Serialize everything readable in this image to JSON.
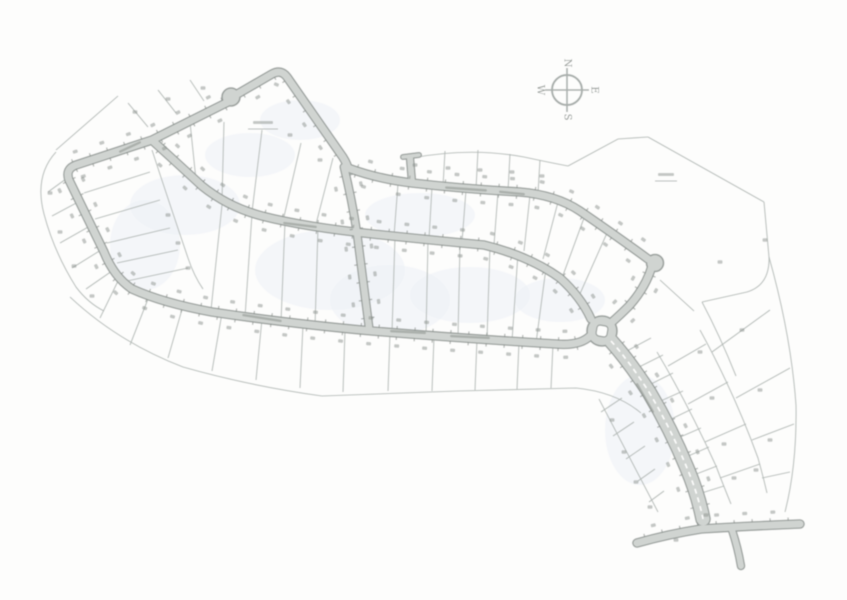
{
  "map": {
    "width": 847,
    "height": 600,
    "colors": {
      "bg": "#fdfdfc",
      "road_fill": "#d0d4d1",
      "road_casing": "#9ba19e",
      "parcel": "#b4bab7",
      "tick": "#878d89",
      "smudge": "#8c928e",
      "wash": "#edf1f5",
      "compass": "#a9afac",
      "letter": "#8f9591",
      "median": "#fdfdfc"
    },
    "roads": [
      {
        "name": "culdesac-hook-road",
        "d": "M 234 96 L 272 74 Q 281 69 287 77 L 340 153 Q 346 161 348 168",
        "w": 7,
        "sides": [
          1
        ]
      },
      {
        "name": "west-loop-and-bottom-road",
        "d": "M 232 100 L 152 140 L 76 165 Q 65 169 69 180 L 104 252 Q 114 277 132 289 Q 163 303 212 312 Q 285 323 372 331 Q 470 339 556 344 Q 580 346 590 336",
        "w": 7,
        "sides": [
          1,
          -1
        ]
      },
      {
        "name": "middle-curving-road",
        "d": "M 154 142 Q 176 162 202 186 Q 228 207 262 216 Q 305 227 373 234 Q 440 241 484 245 Q 529 256 560 278 Q 581 297 591 319",
        "w": 7,
        "sides": [
          1,
          -1
        ]
      },
      {
        "name": "upper-east-road",
        "d": "M 348 168 Q 378 179 412 183 Q 465 189 520 192 Q 556 195 580 211 Q 618 237 648 259",
        "w": 7,
        "sides": [
          1,
          -1
        ]
      },
      {
        "name": "knuckle-to-roundabout-road",
        "d": "M 652 266 Q 646 287 629 306 Q 620 315 612 322",
        "w": 7,
        "sides": [
          1,
          -1
        ]
      },
      {
        "name": "vertical-connector-road",
        "d": "M 344 167 Q 352 200 357 233 Q 363 281 369 327",
        "w": 6.5,
        "sides": [
          1,
          -1
        ]
      },
      {
        "name": "north-stub-road",
        "d": "M 412 182 L 410 158",
        "w": 6,
        "ticks": false,
        "smudges": false
      },
      {
        "name": "north-stub-flare",
        "d": "M 403 157 L 419 155",
        "w": 3.5,
        "ticks": false,
        "smudges": false
      },
      {
        "name": "entry-boulevard",
        "d": "M 611 341 Q 629 361 649 392 Q 671 429 687 468 Q 698 494 703 519",
        "w": 13,
        "sides": [
          1,
          -1
        ]
      },
      {
        "name": "bottom-highway",
        "d": "M 637 543 Q 669 534 701 529 Q 748 526 800 524",
        "w": 7,
        "sides": [
          -1
        ]
      },
      {
        "name": "bottom-highway-stub",
        "d": "M 732 530 Q 738 548 741 566",
        "w": 6,
        "ticks": false,
        "smudges": false
      }
    ],
    "circles": [
      {
        "name": "cul-de-sac-bulb",
        "cx": 231,
        "cy": 97,
        "r": 9
      },
      {
        "name": "knuckle-bulge",
        "cx": 655,
        "cy": 263,
        "r": 8.5
      },
      {
        "name": "roundabout",
        "cx": 602,
        "cy": 331,
        "r": 15,
        "island": true
      }
    ],
    "median": {
      "d": "M 611 341 Q 629 361 649 392 Q 671 429 687 468 Q 698 494 703 519"
    },
    "parcel_lines": [
      "M 70 297 Q 118 342 183 367 Q 250 386 322 396 L 458 391 L 576 388 Q 616 392 641 413",
      "M 412 158 Q 470 147 524 157 Q 547 162 568 166",
      "M 568 166 L 618 139 L 648 137",
      "M 648 137 L 764 202",
      "M 764 202 L 769 257 Q 770 285 747 292 L 702 302",
      "M 769 257 Q 791 335 796 405 Q 797 465 785 512",
      "M 702 302 Q 720 336 736 376",
      "M 660 280 L 694 311",
      "M 657 352 Q 688 404 716 466 Q 724 487 731 504",
      "M 700 330 Q 734 392 758 458 Q 763 476 767 493",
      "M 599 399 Q 628 454 658 512",
      "M 56 152 Q 34 176 44 214 Q 54 252 76 287 Q 88 303 104 311",
      "M 118 96 L 56 150",
      "M 152 150 Q 170 205 188 258 Q 194 276 203 289",
      "M 70 176 L 48 192",
      "M 80 201 L 52 216",
      "M 90 226 L 60 243",
      "M 101 250 L 72 268",
      "M 112 271 L 86 289",
      "M 148 127 L 128 103",
      "M 176 113 L 158 90",
      "M 204 101 L 190 80",
      "M 84 193 L 150 172",
      "M 95 219 L 160 200",
      "M 107 243 L 170 228",
      "M 117 263 L 178 250",
      "M 127 281 L 188 268",
      "M 196 180 L 190 122",
      "M 222 200 L 224 122",
      "M 252 212 L 262 130",
      "M 283 221 L 301 143",
      "M 315 228 L 333 158",
      "M 222 205 L 211 310",
      "M 252 214 L 245 317",
      "M 285 222 L 281 322",
      "M 318 228 L 315 326",
      "M 395 237 L 392 332",
      "M 428 240 L 426 335",
      "M 460 243 L 458 337",
      "M 490 246 L 487 339",
      "M 518 253 L 512 341",
      "M 546 268 L 536 343",
      "M 398 184 L 394 236",
      "M 432 187 L 429 239",
      "M 466 190 L 462 242",
      "M 498 192 L 494 245",
      "M 530 195 L 524 251",
      "M 558 202 L 543 259",
      "M 584 218 L 562 278",
      "M 607 233 L 579 296",
      "M 445 151 L 443 186",
      "M 478 150 L 476 189",
      "M 510 154 L 508 191",
      "M 540 160 L 538 193",
      "M 118 281 L 100 318",
      "M 148 299 L 130 345",
      "M 183 306 L 168 358",
      "M 222 313 L 212 371",
      "M 262 319 L 256 380",
      "M 303 325 L 300 388",
      "M 345 330 L 343 392",
      "M 390 333 L 388 391",
      "M 434 337 L 432 391",
      "M 477 339 L 475 390",
      "M 519 342 L 517 389",
      "M 553 344 L 551 388",
      "M 625 352 L 651 338",
      "M 635 369 L 663 355",
      "M 645 387 L 673 373",
      "M 654 404 L 683 391",
      "M 663 423 L 692 409",
      "M 671 441 L 701 428",
      "M 679 460 L 709 447",
      "M 686 478 L 717 466",
      "M 692 496 L 724 486",
      "M 668 366 L 706 344",
      "M 688 404 L 728 382",
      "M 705 442 L 746 424",
      "M 720 478 L 760 464",
      "M 712 352 L 770 310",
      "M 736 398 L 790 368",
      "M 752 440 L 794 424",
      "M 762 478 L 790 472",
      "M 622 398 L 601 412",
      "M 634 422 L 613 436",
      "M 645 446 L 626 459",
      "M 655 469 L 638 481",
      "M 664 491 L 649 502"
    ],
    "washes": [
      [
        185,
        205,
        55,
        30
      ],
      [
        330,
        270,
        75,
        40
      ],
      [
        470,
        295,
        60,
        28
      ],
      [
        420,
        215,
        55,
        22
      ],
      [
        250,
        155,
        45,
        22
      ],
      [
        640,
        430,
        35,
        55
      ],
      [
        145,
        245,
        35,
        45
      ],
      [
        390,
        300,
        60,
        35
      ],
      [
        560,
        300,
        45,
        22
      ],
      [
        300,
        120,
        40,
        20
      ]
    ],
    "extra_smudges": [
      [
        50,
        193
      ],
      [
        60,
        232
      ],
      [
        74,
        266
      ],
      [
        92,
        296
      ],
      [
        135,
        112
      ],
      [
        168,
        99
      ],
      [
        203,
        88
      ],
      [
        720,
        262
      ],
      [
        742,
        330
      ],
      [
        760,
        390
      ],
      [
        770,
        440
      ],
      [
        756,
        470
      ],
      [
        700,
        352
      ],
      [
        712,
        398
      ],
      [
        724,
        444
      ],
      [
        734,
        478
      ],
      [
        612,
        420
      ],
      [
        624,
        452
      ],
      [
        636,
        482
      ],
      [
        650,
        507
      ],
      [
        676,
        540
      ],
      [
        706,
        515
      ],
      [
        290,
        135
      ],
      [
        320,
        160
      ],
      [
        168,
        215
      ],
      [
        178,
        243
      ],
      [
        188,
        268
      ],
      [
        415,
        165
      ],
      [
        448,
        168
      ],
      [
        480,
        170
      ],
      [
        512,
        172
      ],
      [
        542,
        176
      ],
      [
        765,
        240
      ]
    ],
    "street_smudges": [
      {
        "x": 466,
        "y": 189,
        "len": 42,
        "angle": 4
      },
      {
        "x": 512,
        "y": 193,
        "len": 26,
        "angle": 6
      },
      {
        "x": 300,
        "y": 225,
        "len": 34,
        "angle": 7
      },
      {
        "x": 262,
        "y": 318,
        "len": 40,
        "angle": 9
      },
      {
        "x": 408,
        "y": 332,
        "len": 36,
        "angle": 3
      },
      {
        "x": 470,
        "y": 337,
        "len": 40,
        "angle": 3
      },
      {
        "x": 645,
        "y": 398,
        "len": 34,
        "angle": 60
      },
      {
        "x": 130,
        "y": 147,
        "len": 24,
        "angle": -25
      }
    ],
    "labels": [
      {
        "x": 263,
        "y": 123,
        "w": 20,
        "underline": 30
      },
      {
        "x": 666,
        "y": 175,
        "w": 16,
        "underline": 22
      }
    ],
    "compass": {
      "cx": 567,
      "cy": 90,
      "r": 15,
      "arm": 22,
      "letter_offset": 27,
      "letter_rotation": 90,
      "letters": [
        {
          "t": "N",
          "dx": 0,
          "dy": -1
        },
        {
          "t": "E",
          "dx": 1,
          "dy": 0
        },
        {
          "t": "S",
          "dx": 0,
          "dy": 1
        },
        {
          "t": "W",
          "dx": -1,
          "dy": 0
        }
      ]
    }
  }
}
